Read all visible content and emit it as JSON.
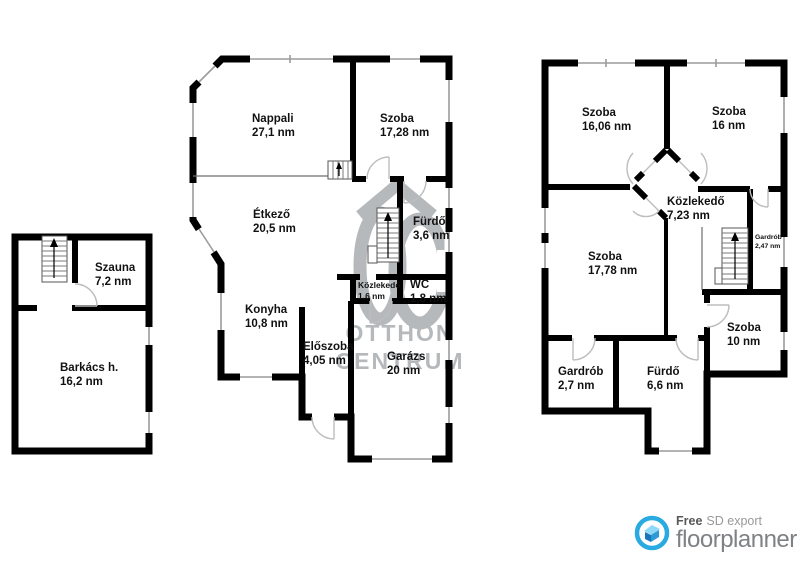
{
  "plans": {
    "annex": {
      "rooms": [
        {
          "name": "Szauna",
          "area": "7,2 nm"
        },
        {
          "name": "Barkács h.",
          "area": "16,2 nm"
        }
      ]
    },
    "ground": {
      "rooms": [
        {
          "name": "Nappali",
          "area": "27,1 nm"
        },
        {
          "name": "Szoba",
          "area": "17,28 nm"
        },
        {
          "name": "Étkező",
          "area": "20,5 nm"
        },
        {
          "name": "Fürdő",
          "area": "3,6 nm"
        },
        {
          "name": "Közlekedő",
          "area": "1,6 nm"
        },
        {
          "name": "WC",
          "area": "1,8 nm"
        },
        {
          "name": "Konyha",
          "area": "10,8 nm"
        },
        {
          "name": "Előszoba",
          "area": "4,05 nm"
        },
        {
          "name": "Garázs",
          "area": "20 nm"
        }
      ]
    },
    "upper": {
      "rooms": [
        {
          "name": "Szoba",
          "area": "16,06 nm"
        },
        {
          "name": "Szoba",
          "area": "16 nm"
        },
        {
          "name": "Közlekedő",
          "area": "7,23 nm"
        },
        {
          "name": "Gardrób",
          "area": "2,47 nm"
        },
        {
          "name": "Szoba",
          "area": "17,78 nm"
        },
        {
          "name": "Szoba",
          "area": "10 nm"
        },
        {
          "name": "Gardrób",
          "area": "2,7 nm"
        },
        {
          "name": "Fürdő",
          "area": "6,6 nm"
        }
      ]
    }
  },
  "watermark": {
    "line1": "OTTHON",
    "line2": "CENTRUM"
  },
  "footer": {
    "free": "Free",
    "export": "SD export",
    "brand": "floorplanner",
    "accent": "#29abe2",
    "brand_color": "#7f8285"
  },
  "colors": {
    "wall": "#000000",
    "window": "#9b9b9b",
    "watermark": "#b5b9bc"
  }
}
